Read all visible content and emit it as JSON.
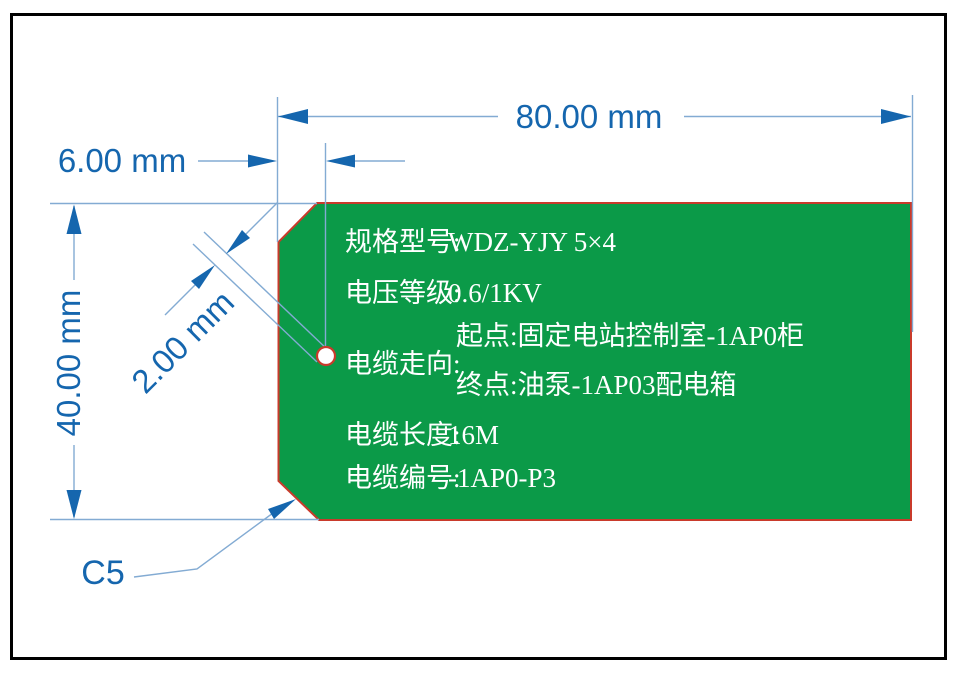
{
  "drawing": {
    "dims": {
      "width": "80.00 mm",
      "hole_offset": "6.00 mm",
      "height": "40.00 mm",
      "hole_diameter": "2.00 mm",
      "chamfer": "C5"
    },
    "tag": {
      "rows": [
        {
          "label": "规格型号:",
          "value": "WDZ-YJY 5×4"
        },
        {
          "label": "电压等级:",
          "value": "0.6/1KV"
        },
        {
          "label": "电缆走向:",
          "start": "起点:固定电站控制室-1AP0柜",
          "end": "终点:油泵-1AP03配电箱"
        },
        {
          "label": "电缆长度:",
          "value": "16M"
        },
        {
          "label": "电缆编号:",
          "value": "-1AP0-P3"
        }
      ]
    },
    "colors": {
      "tag_fill": "#0b9a48",
      "tag_border": "#c93a2b",
      "dim_text_blue": "#1566ae",
      "dim_line_blue": "#83abd3",
      "frame_black": "#000000",
      "tag_text_white": "#ffffff"
    }
  }
}
